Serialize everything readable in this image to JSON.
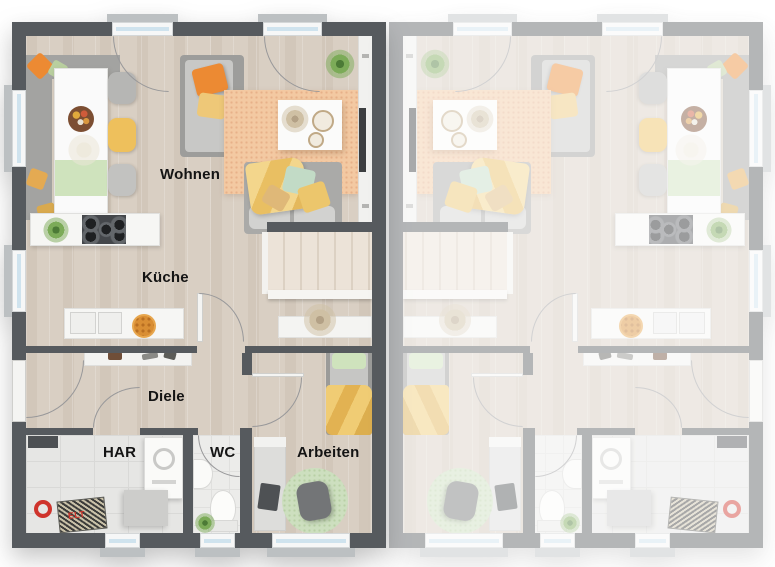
{
  "rooms": {
    "wohnen": "Wohnen",
    "kueche": "Küche",
    "diele": "Diele",
    "har": "HAR",
    "wc": "WC",
    "arbeiten": "Arbeiten"
  },
  "elt_label": "ELT",
  "colors": {
    "wall_dark": "#565a5e",
    "floor_wood": "#d9cfc3",
    "floor_tile": "#e6e6e4",
    "stair_tread": "#ece3d8",
    "rug_orange": "#f3c9a2",
    "rug_green": "#cddfbf",
    "sofa_gray": "#aaaaa8",
    "accent_orange": "#ec8a33",
    "accent_yellow": "#eec05c",
    "accent_green": "#cfe3bd",
    "window_glass": "#cfe3ee",
    "window_frame": "#f6f7f7",
    "sill_gray": "#bcc0c2",
    "elt_red": "#cf342c"
  }
}
